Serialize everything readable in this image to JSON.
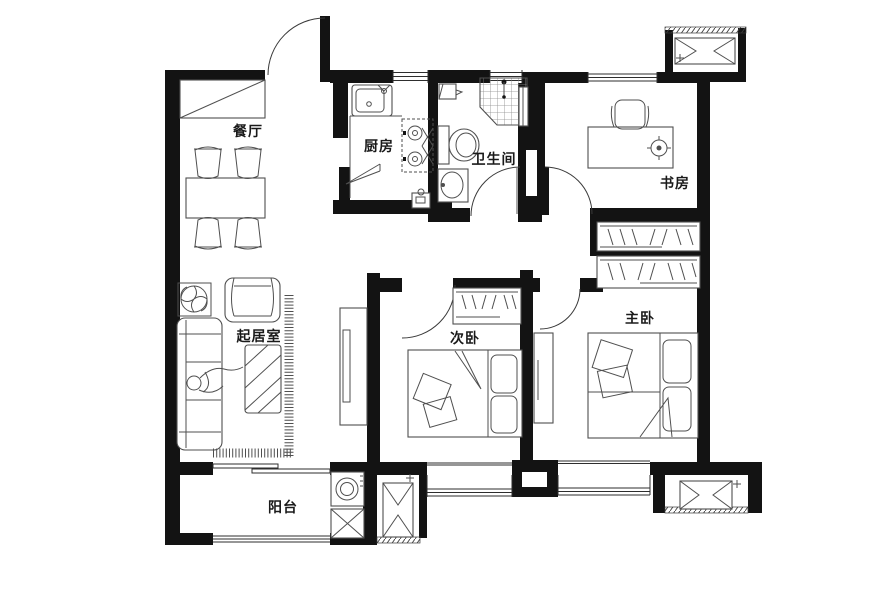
{
  "floor_plan": {
    "title": "apartment-floor-plan",
    "rooms": {
      "dining": {
        "label": "餐厅"
      },
      "kitchen": {
        "label": "厨房"
      },
      "bathroom": {
        "label": "卫生间"
      },
      "study": {
        "label": "书房"
      },
      "living": {
        "label": "起居室"
      },
      "secondary_bedroom": {
        "label": "次卧"
      },
      "master_bedroom": {
        "label": "主卧"
      },
      "balcony": {
        "label": "阳台"
      }
    },
    "fixtures": {
      "entrance_door": "entry swing door with quarter-circle arc",
      "entry_cabinet": "shoe cabinet with diagonal",
      "dining_set": "table with four chairs",
      "kitchen_sink": "counter sink with faucet",
      "kitchen_stove": "two-burner gas stove",
      "gas_meter": "small gas box",
      "shower": "corner shower with tiled floor",
      "toilet": "tank and bowl",
      "bath_sink": "wash basin",
      "study_desk": "desk with chair and lamp symbol",
      "wardrobes": "hanger-hatch closets",
      "beds": "double beds with pillows and folded quilt",
      "dresser": "bedside cabinet",
      "sofa": "three-seat sofa with figure",
      "armchair": "single armchair",
      "coffee_table": "striped glass table",
      "area_rug": "fringed rug edge",
      "plant": "pinwheel potted plant",
      "tv_cabinet": "media cabinet",
      "washing_machine": "drum washer",
      "storage_box": "crossed cabinet",
      "ac_units": "three outdoor A/C platforms",
      "duct_shaft": "black shaft with white notch",
      "bay_windows": "protruding window sills"
    },
    "colors": {
      "wall": "#131313",
      "furniture_line": "#4f4f4f",
      "background": "#ffffff"
    }
  }
}
